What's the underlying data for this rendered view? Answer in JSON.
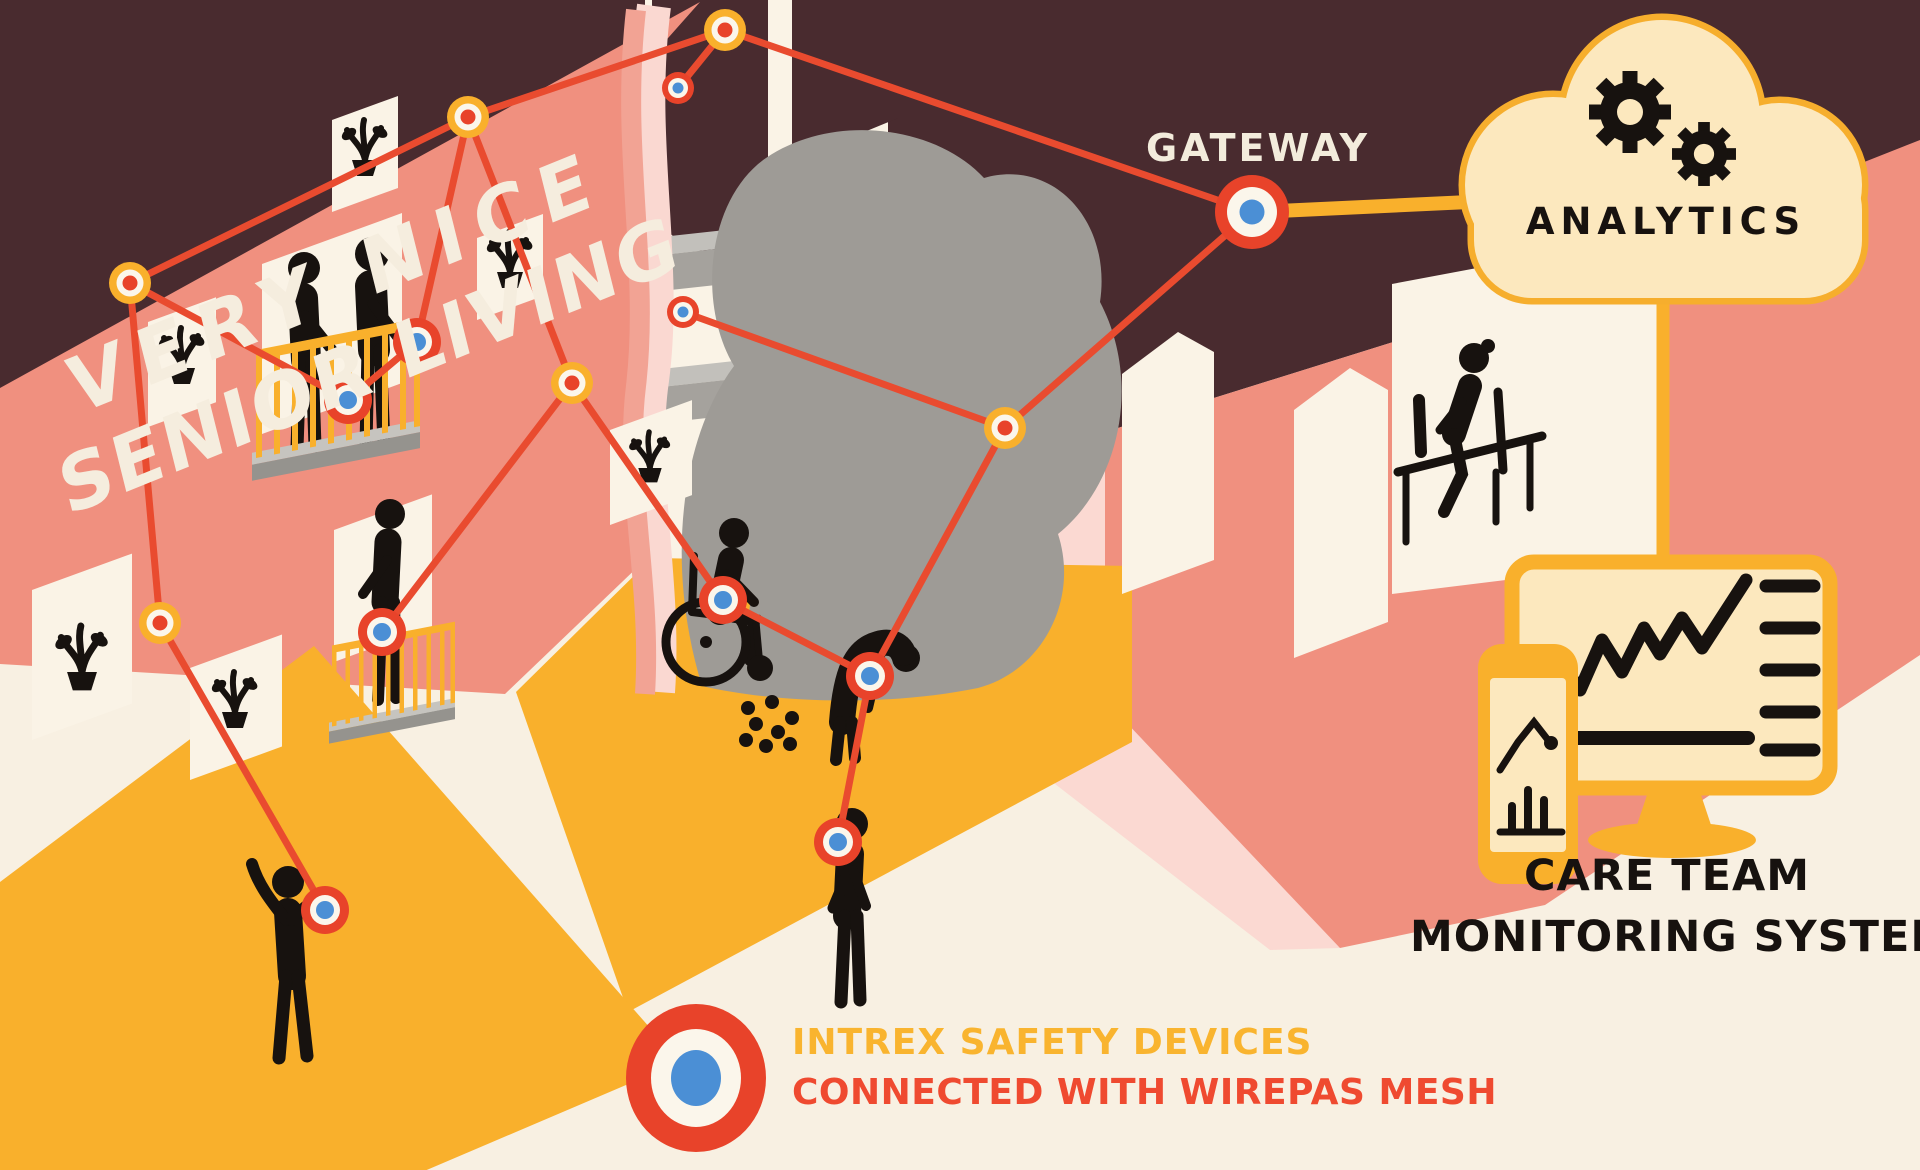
{
  "title": {
    "line1": "VERY NICE",
    "line2": "SENIOR LIVING"
  },
  "labels": {
    "gateway": "GATEWAY",
    "analytics": "ANALYTICS",
    "care_team_line1": "CARE TEAM",
    "care_team_line2": "MONITORING SYSTEM"
  },
  "legend": {
    "line1": "INTREX SAFETY DEVICES",
    "line2": "CONNECTED WITH WIREPAS MESH"
  },
  "colors": {
    "background_cream": "#F8F0E2",
    "window_cream": "#FAF3E6",
    "roof_maroon": "#492B2F",
    "wall_salmon": "#F0907F",
    "wall_pink_light": "#FBD9D2",
    "floor_gold": "#F9B02C",
    "mesh_red": "#E94B2F",
    "device_ring_red": "#E8432A",
    "device_core_blue": "#4B8FD5",
    "anchor_ring_gold": "#F9B02C",
    "silhouette_black": "#17120F",
    "cloud_fill": "#FCE8BE",
    "cloud_border": "#F6AE2D",
    "ring_white": "#FBF6EB"
  },
  "network": {
    "nodes": [
      {
        "id": "A",
        "type": "anchor",
        "x": 725,
        "y": 30
      },
      {
        "id": "B",
        "type": "device_small",
        "x": 678,
        "y": 88
      },
      {
        "id": "B2",
        "type": "device_small",
        "x": 683,
        "y": 312
      },
      {
        "id": "C",
        "type": "anchor",
        "x": 468,
        "y": 117
      },
      {
        "id": "D",
        "type": "anchor",
        "x": 130,
        "y": 283
      },
      {
        "id": "E",
        "type": "device",
        "x": 348,
        "y": 400
      },
      {
        "id": "F",
        "type": "device",
        "x": 417,
        "y": 342
      },
      {
        "id": "G",
        "type": "anchor",
        "x": 572,
        "y": 383
      },
      {
        "id": "H",
        "type": "anchor",
        "x": 160,
        "y": 623
      },
      {
        "id": "I",
        "type": "device",
        "x": 382,
        "y": 632
      },
      {
        "id": "J",
        "type": "device",
        "x": 723,
        "y": 600
      },
      {
        "id": "K",
        "type": "device",
        "x": 870,
        "y": 676
      },
      {
        "id": "L",
        "type": "anchor",
        "x": 1005,
        "y": 428
      },
      {
        "id": "M",
        "type": "device",
        "x": 838,
        "y": 842
      },
      {
        "id": "N",
        "type": "device",
        "x": 325,
        "y": 910
      },
      {
        "id": "GW",
        "type": "gateway",
        "x": 1252,
        "y": 212
      }
    ],
    "edges": [
      [
        "A",
        "C"
      ],
      [
        "A",
        "B"
      ],
      [
        "A",
        "GW"
      ],
      [
        "C",
        "D"
      ],
      [
        "C",
        "F"
      ],
      [
        "C",
        "G"
      ],
      [
        "F",
        "E"
      ],
      [
        "D",
        "E"
      ],
      [
        "D",
        "H"
      ],
      [
        "H",
        "N"
      ],
      [
        "G",
        "I"
      ],
      [
        "G",
        "J"
      ],
      [
        "J",
        "K"
      ],
      [
        "K",
        "M"
      ],
      [
        "GW",
        "L"
      ],
      [
        "L",
        "B2"
      ],
      [
        "L",
        "K"
      ]
    ]
  }
}
